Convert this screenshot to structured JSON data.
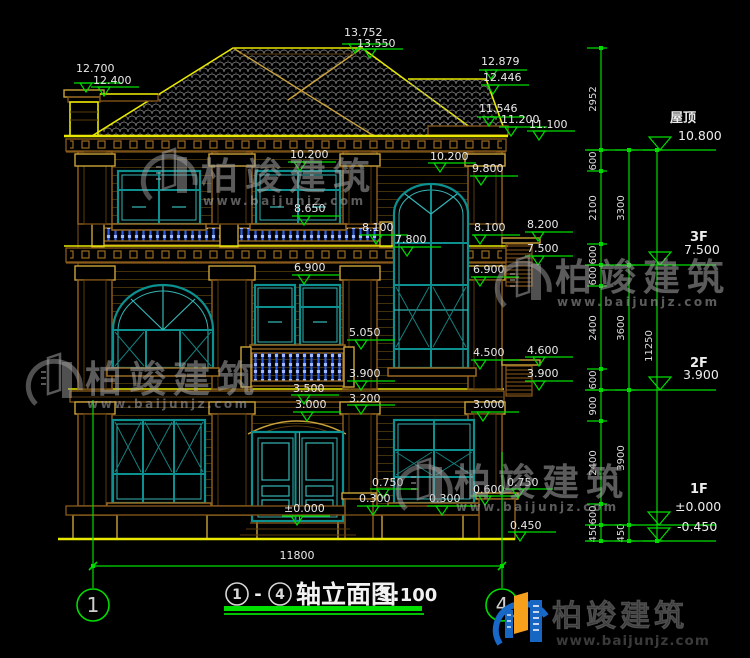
{
  "title": {
    "axis_a": "1",
    "dash": "-",
    "axis_b": "4",
    "name": "轴立面图",
    "scale": "1:100"
  },
  "axes": {
    "left": "1",
    "right": "4",
    "span": "11800"
  },
  "floor_marks": [
    {
      "label": "屋顶",
      "value": "10.800"
    },
    {
      "label": "3F",
      "value": "7.500"
    },
    {
      "label": "2F",
      "value": "3.900"
    },
    {
      "label": "1F",
      "value": "±0.000"
    },
    {
      "label": "",
      "value": "-0.450"
    }
  ],
  "elevation_marks": [
    {
      "value": "12.700",
      "x": 76,
      "y": 72,
      "tip": [
        86,
        92
      ]
    },
    {
      "value": "12.400",
      "x": 93,
      "y": 84,
      "tip": [
        104,
        96
      ]
    },
    {
      "value": "13.752",
      "x": 344,
      "y": 36,
      "tip": [
        355,
        53
      ]
    },
    {
      "value": "13.550",
      "x": 357,
      "y": 47,
      "tip": [
        370,
        58
      ]
    },
    {
      "value": "12.879",
      "x": 481,
      "y": 65,
      "tip": [
        491,
        79
      ]
    },
    {
      "value": "12.446",
      "x": 483,
      "y": 81,
      "tip": [
        493,
        94
      ]
    },
    {
      "value": "11.546",
      "x": 479,
      "y": 112,
      "tip": [
        489,
        126
      ]
    },
    {
      "value": "11.200",
      "x": 501,
      "y": 123,
      "tip": [
        511,
        136
      ]
    },
    {
      "value": "11.100",
      "x": 529,
      "y": 128,
      "tip": [
        539,
        140
      ]
    },
    {
      "value": "10.200",
      "x": 290,
      "y": 158,
      "tip": [
        300,
        171
      ]
    },
    {
      "value": "10.200",
      "x": 430,
      "y": 160,
      "tip": [
        440,
        172
      ]
    },
    {
      "value": "9.800",
      "x": 472,
      "y": 172,
      "tip": [
        481,
        185
      ]
    },
    {
      "value": "8.650",
      "x": 294,
      "y": 212,
      "tip": [
        304,
        225
      ]
    },
    {
      "value": "8.100",
      "x": 362,
      "y": 231,
      "tip": [
        376,
        244
      ]
    },
    {
      "value": "8.200",
      "x": 527,
      "y": 228,
      "tip": [
        538,
        241
      ]
    },
    {
      "value": "7.800",
      "x": 395,
      "y": 243,
      "tip": [
        407,
        256
      ]
    },
    {
      "value": "8.100",
      "x": 474,
      "y": 231,
      "tip": [
        480,
        244
      ]
    },
    {
      "value": "7.500",
      "x": 527,
      "y": 252,
      "tip": [
        538,
        265
      ]
    },
    {
      "value": "6.900",
      "x": 294,
      "y": 271,
      "tip": [
        304,
        284
      ]
    },
    {
      "value": "6.900",
      "x": 473,
      "y": 273,
      "tip": [
        480,
        286
      ]
    },
    {
      "value": "5.050",
      "x": 349,
      "y": 336,
      "tip": [
        361,
        349
      ]
    },
    {
      "value": "4.500",
      "x": 473,
      "y": 356,
      "tip": [
        480,
        369
      ]
    },
    {
      "value": "4.600",
      "x": 527,
      "y": 354,
      "tip": [
        539,
        366
      ]
    },
    {
      "value": "3.900",
      "x": 349,
      "y": 377,
      "tip": [
        361,
        390
      ]
    },
    {
      "value": "3.900",
      "x": 527,
      "y": 377,
      "tip": [
        539,
        390
      ]
    },
    {
      "value": "3.500",
      "x": 293,
      "y": 392,
      "tip": [
        304,
        404
      ]
    },
    {
      "value": "3.200",
      "x": 349,
      "y": 402,
      "tip": [
        361,
        414
      ]
    },
    {
      "value": "3.000",
      "x": 295,
      "y": 408,
      "tip": [
        307,
        421
      ]
    },
    {
      "value": "3.000",
      "x": 473,
      "y": 408,
      "tip": [
        483,
        421
      ]
    },
    {
      "value": "0.750",
      "x": 372,
      "y": 486,
      "tip": [
        383,
        498
      ]
    },
    {
      "value": "0.300",
      "x": 359,
      "y": 502,
      "tip": [
        373,
        515
      ]
    },
    {
      "value": "0.300",
      "x": 429,
      "y": 502,
      "tip": [
        442,
        515
      ]
    },
    {
      "value": "0.600",
      "x": 473,
      "y": 493,
      "tip": [
        485,
        505
      ]
    },
    {
      "value": "0.750",
      "x": 507,
      "y": 486,
      "tip": [
        518,
        498
      ]
    },
    {
      "value": "±0.000",
      "x": 284,
      "y": 512,
      "tip": [
        297,
        525
      ]
    },
    {
      "value": "0.450",
      "x": 510,
      "y": 529,
      "tip": [
        520,
        541
      ]
    }
  ],
  "chains": [
    {
      "x": 601,
      "ticks": [
        48,
        150,
        171,
        244,
        265,
        286,
        369,
        390,
        421,
        504,
        525,
        541
      ],
      "labels": [
        {
          "t": "2952",
          "y": 99
        },
        {
          "t": "600",
          "y": 161
        },
        {
          "t": "2100",
          "y": 208
        },
        {
          "t": "600",
          "y": 255
        },
        {
          "t": "600",
          "y": 276
        },
        {
          "t": "2400",
          "y": 328
        },
        {
          "t": "600",
          "y": 380
        },
        {
          "t": "900",
          "y": 406
        },
        {
          "t": "2400",
          "y": 463
        },
        {
          "t": "600",
          "y": 515
        },
        {
          "t": "450",
          "y": 533
        }
      ]
    },
    {
      "x": 629,
      "ticks": [
        150,
        265,
        390,
        525,
        541
      ],
      "labels": [
        {
          "t": "3300",
          "y": 208
        },
        {
          "t": "3600",
          "y": 328
        },
        {
          "t": "3900",
          "y": 458
        },
        {
          "t": "450",
          "y": 533
        }
      ]
    },
    {
      "x": 657,
      "ticks": [
        150,
        541
      ],
      "labels": [
        {
          "t": "11250",
          "y": 346
        }
      ]
    }
  ],
  "rails": [
    {
      "y": 150,
      "x1": 585,
      "x2": 716
    },
    {
      "y": 265,
      "x1": 585,
      "x2": 716
    },
    {
      "y": 390,
      "x1": 585,
      "x2": 716
    },
    {
      "y": 525,
      "x1": 585,
      "x2": 716
    },
    {
      "y": 541,
      "x1": 585,
      "x2": 716
    }
  ],
  "watermark": {
    "brand": "柏竣建筑",
    "url": "www.baijunjz.com"
  },
  "logo": {
    "brand": "柏竣建筑",
    "url": "www.baijunjz.com"
  },
  "colors": {
    "dim_green": "#00dc00",
    "outline_yellow": "#e8e800",
    "trim_brown": "#8a5a1a",
    "window_teal": "#0d9090",
    "baluster_blue": "#2e5fe0",
    "logo_blue": "#1868c8",
    "logo_orange": "#f6a01c"
  }
}
